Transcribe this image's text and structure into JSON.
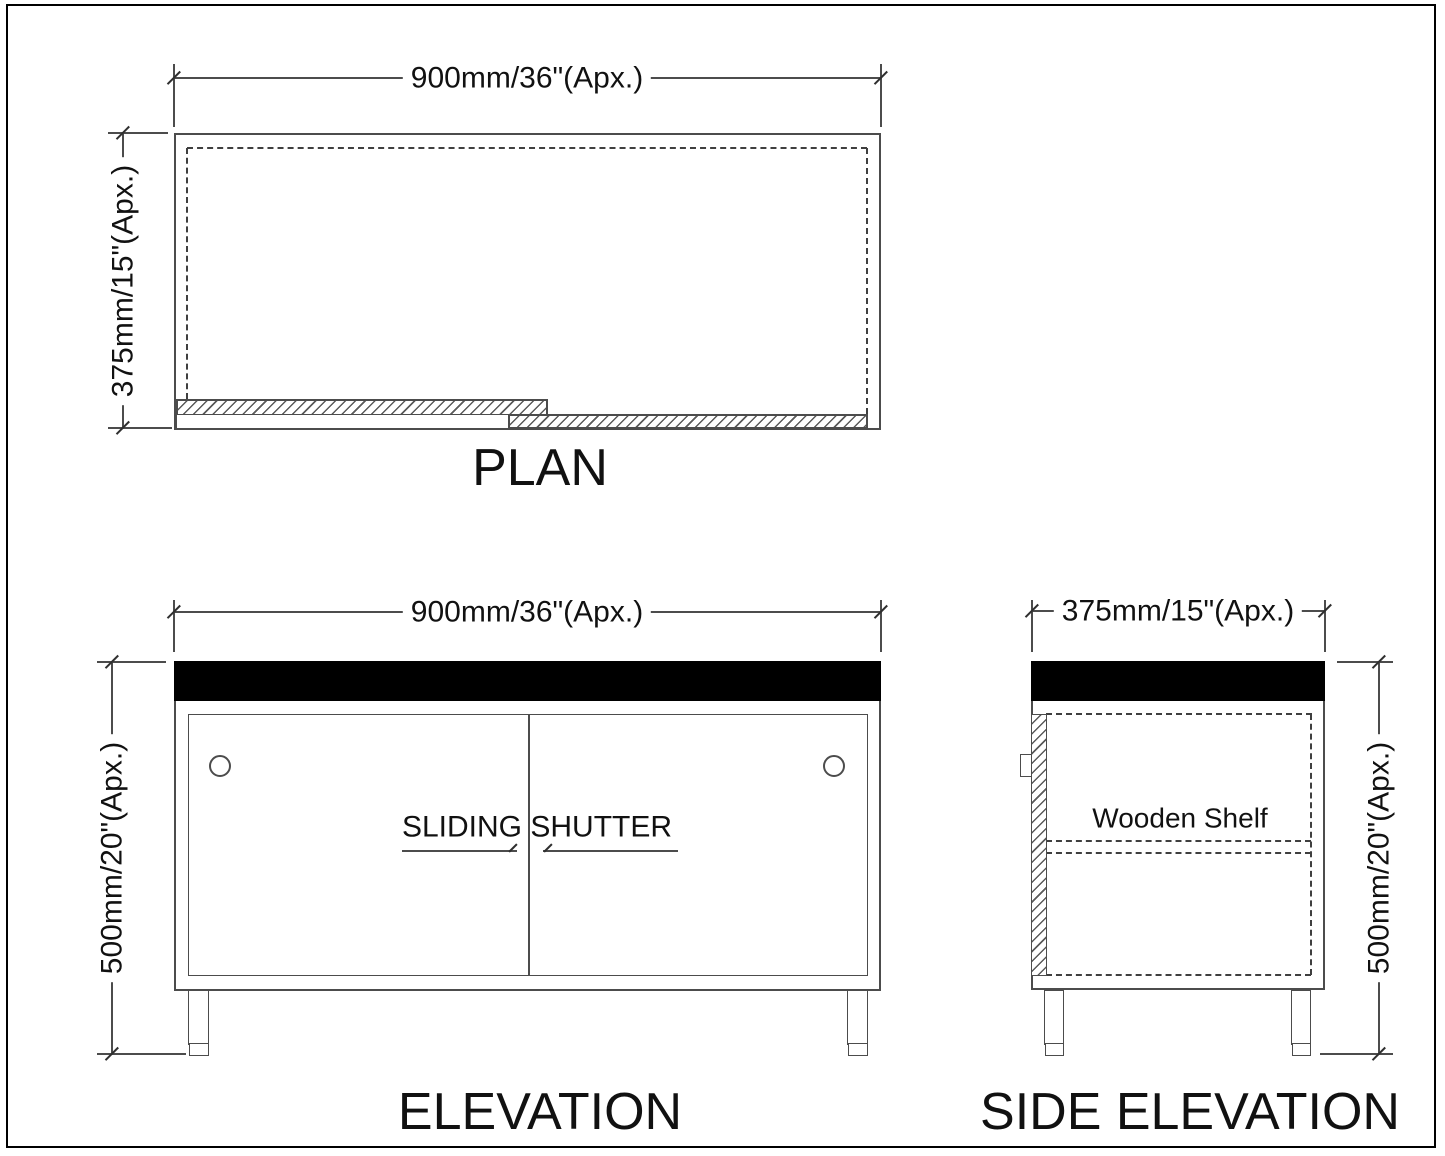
{
  "drawing": {
    "plan": {
      "title": "PLAN",
      "width_dim": "900mm/36\"(Apx.)",
      "depth_dim": "375mm/15\"(Apx.)"
    },
    "elevation": {
      "title": "ELEVATION",
      "width_dim": "900mm/36\"(Apx.)",
      "height_dim": "500mm/20\"(Apx.)",
      "shutter_label": "SLIDING SHUTTER"
    },
    "side_elevation": {
      "title": "SIDE ELEVATION",
      "depth_dim": "375mm/15\"(Apx.)",
      "height_dim": "500mm/20\"(Apx.)",
      "shelf_label": "Wooden Shelf"
    },
    "colors": {
      "line": "#4c4c4c",
      "text": "#111111",
      "countertop": "#000000",
      "background": "#ffffff"
    }
  }
}
